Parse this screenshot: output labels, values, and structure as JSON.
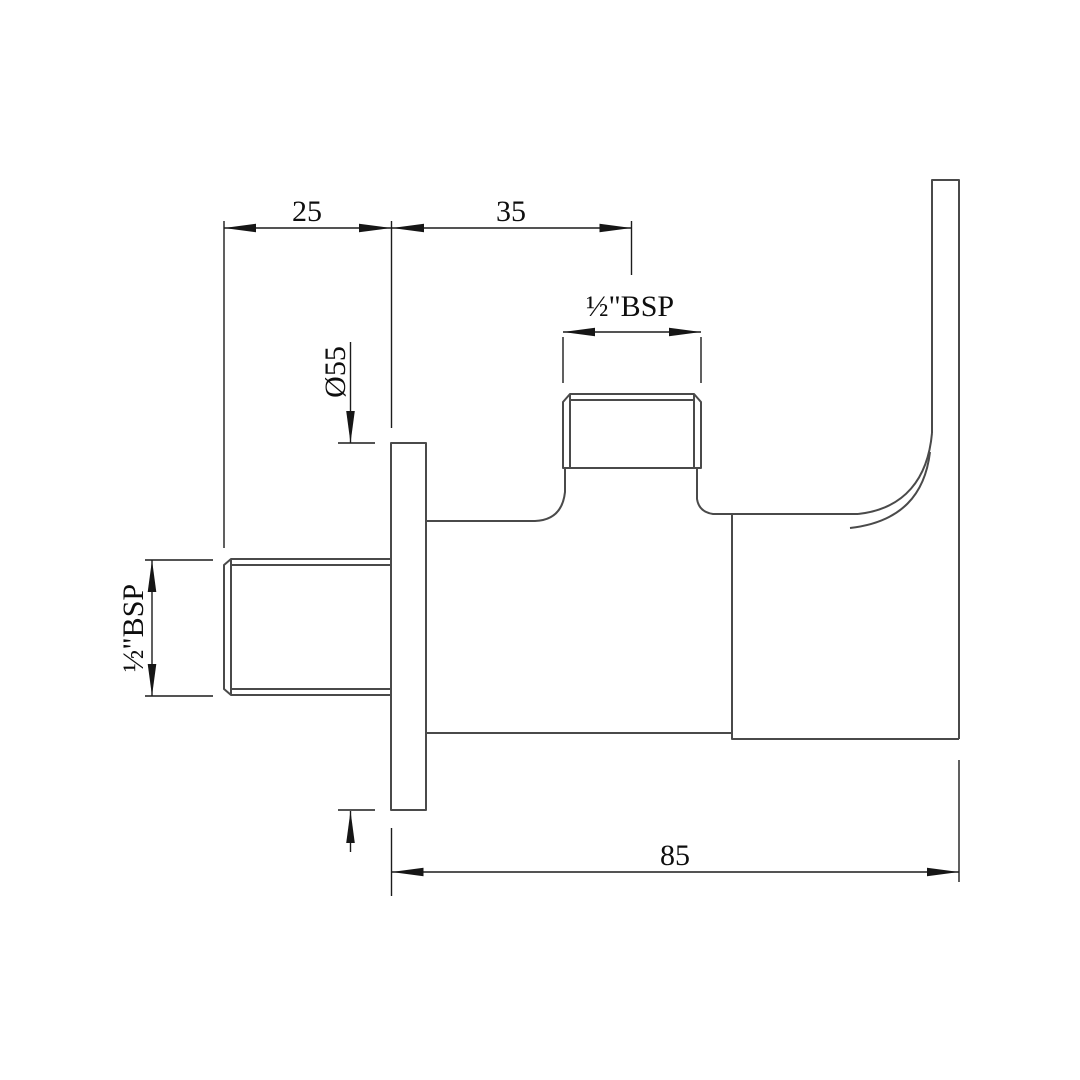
{
  "drawing": {
    "kind": "technical-dimension-drawing",
    "subject": "angle-valve-side-elevation",
    "colors": {
      "background": "#ffffff",
      "part_outline": "#4a4a4a",
      "dimension_line": "#1c1c1c",
      "text": "#0e0e0e"
    },
    "dims": {
      "offset_25": {
        "label": "25",
        "value": 25,
        "unit": "mm"
      },
      "offset_35": {
        "label": "35",
        "value": 35,
        "unit": "mm"
      },
      "outlet_bsp": {
        "label": "½\"BSP"
      },
      "inlet_bsp": {
        "label": "½\"BSP"
      },
      "flange_dia": {
        "label": "Ø55",
        "value": 55,
        "unit": "mm"
      },
      "depth_85": {
        "label": "85",
        "value": 85,
        "unit": "mm"
      }
    }
  }
}
